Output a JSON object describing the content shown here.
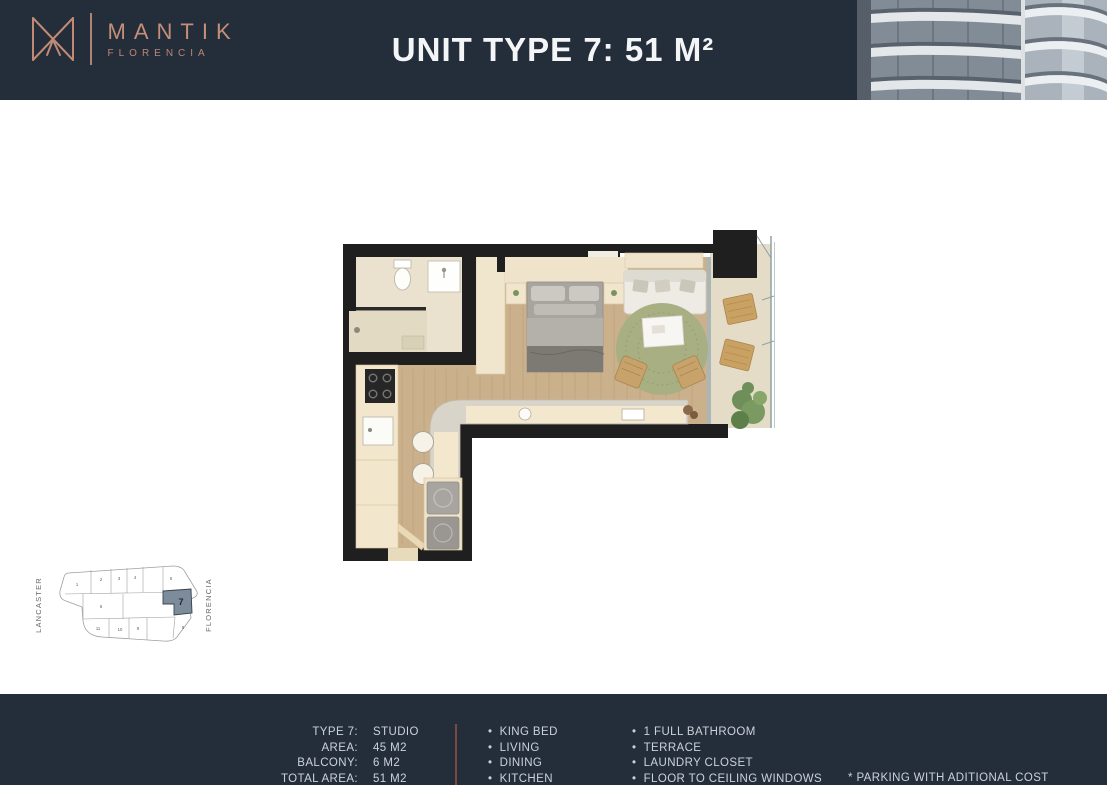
{
  "header": {
    "brand": "MANTIK",
    "brand_sub": "FLORENCIA",
    "title": "UNIT TYPE 7: 51 M²"
  },
  "colors": {
    "header_bg": "#242d3a",
    "accent_copper": "#c58e77",
    "divider_maroon": "#7b4a43",
    "keyplan_highlight": "#7d8c9a",
    "wall_black": "#1f1f1f",
    "wood_floor": "#cbb18b",
    "rug_green": "#a8af82"
  },
  "keyplan": {
    "left_label": "LANCASTER",
    "right_label": "FLORENCIA",
    "highlighted_unit": "7",
    "units": [
      "1",
      "2",
      "3",
      "4",
      "5",
      "6",
      "7",
      "8",
      "9",
      "10",
      "11"
    ]
  },
  "footer": {
    "specs": [
      {
        "label": "TYPE 7:",
        "value": "STUDIO"
      },
      {
        "label": "AREA:",
        "value": "45 M2"
      },
      {
        "label": "BALCONY:",
        "value": "6 M2"
      },
      {
        "label": "TOTAL AREA:",
        "value": "51 M2"
      }
    ],
    "features_col1": [
      "KING BED",
      "LIVING",
      "DINING",
      "KITCHEN"
    ],
    "features_col2": [
      "1 FULL BATHROOM",
      "TERRACE",
      "LAUNDRY CLOSET",
      "FLOOR TO CEILING WINDOWS"
    ],
    "note": "* PARKING WITH ADITIONAL COST"
  }
}
